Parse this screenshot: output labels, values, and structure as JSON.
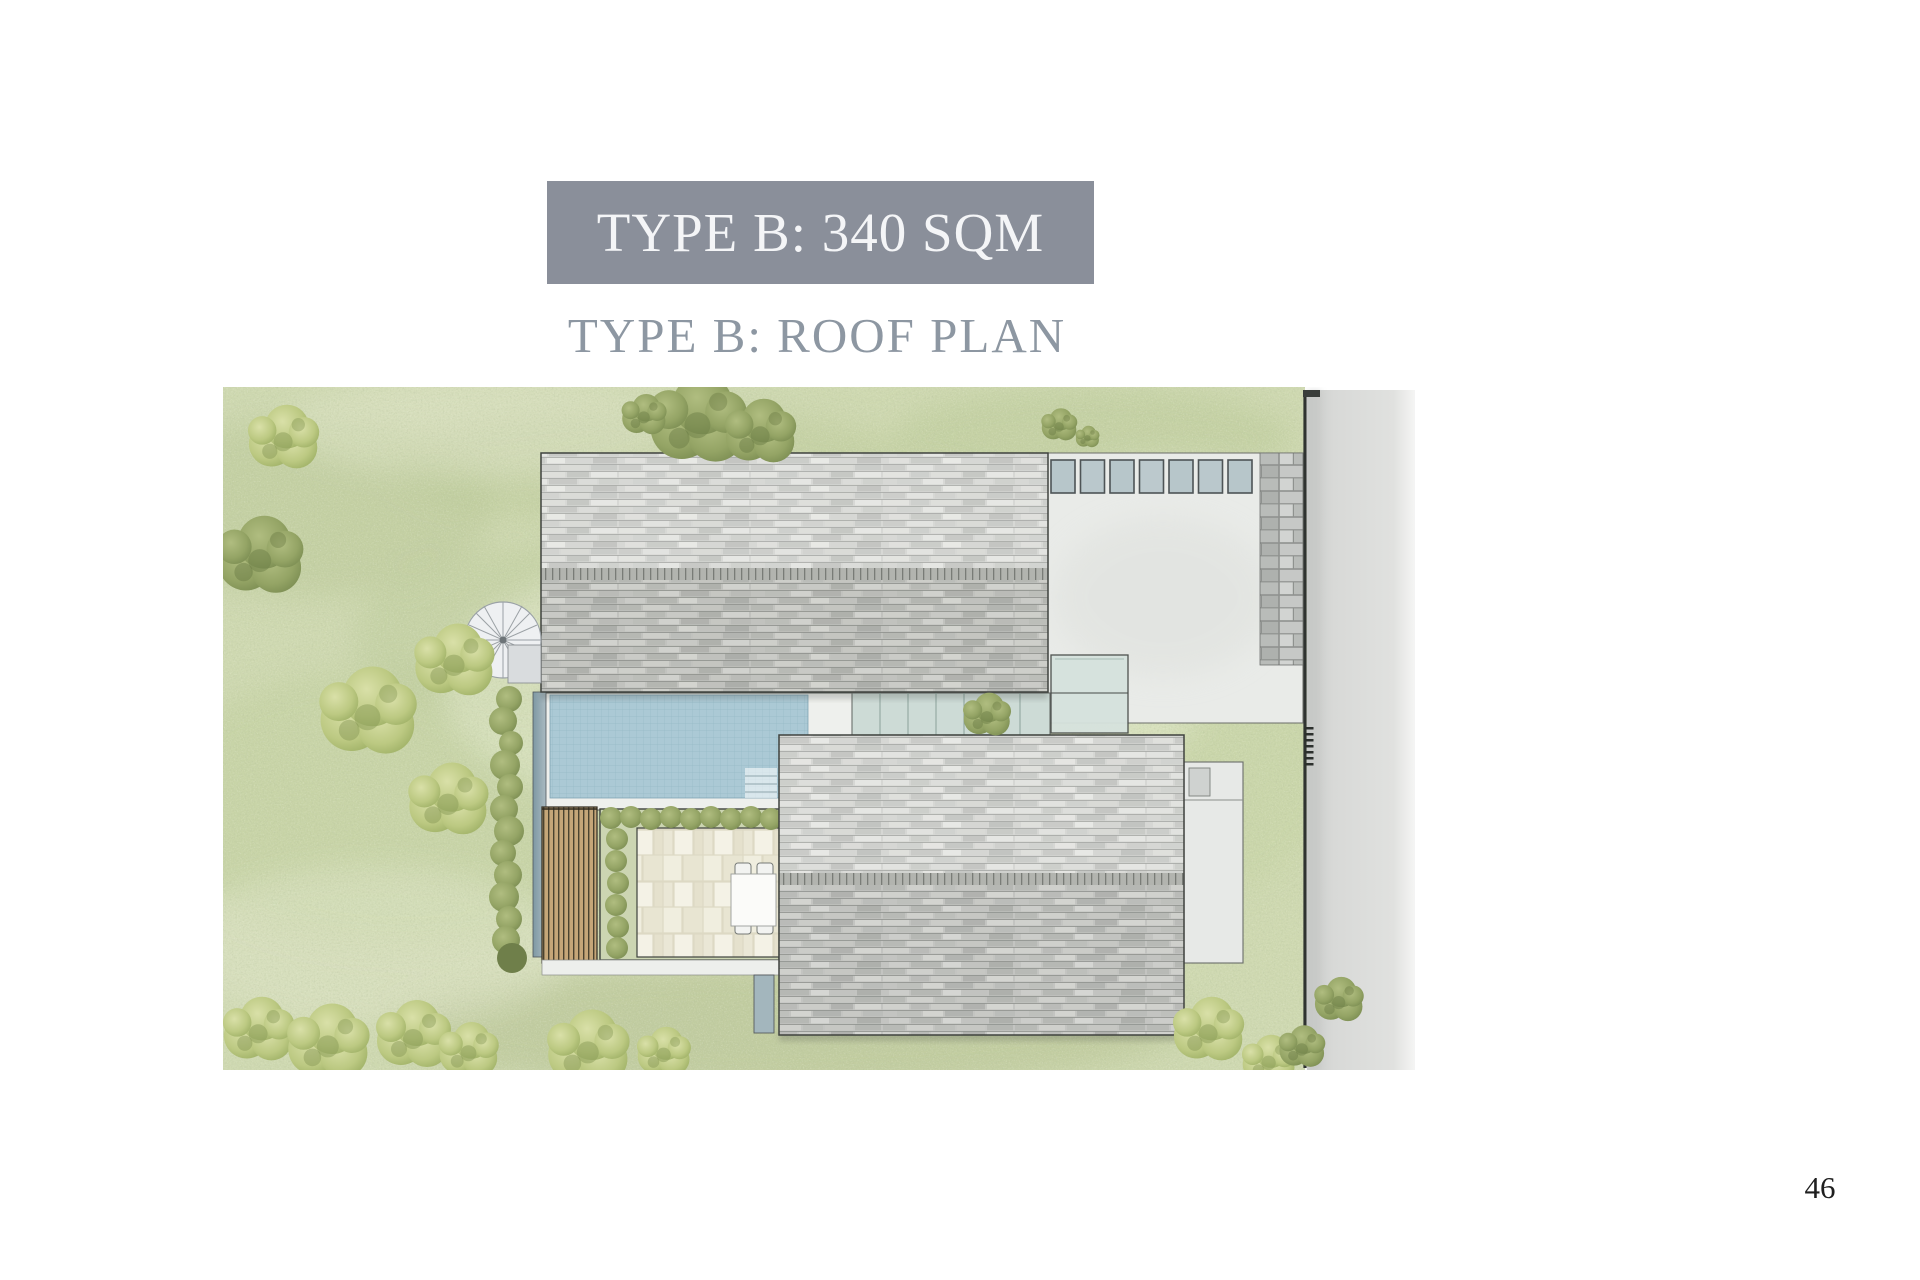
{
  "page": {
    "title_banner": "TYPE B: 340 SQM",
    "subtitle": "TYPE B: ROOF PLAN",
    "page_number": "46"
  },
  "plan": {
    "alt": "Watercolor roof plan: two grey shingled roofs, concrete terrace with seven skylights, stone paver path, swimming pool, glass canopy, spiral stair, timber pergola, paved courtyard with dining table, lawn with trees, side road"
  },
  "theme": {
    "page-bg": "#ffffff",
    "banner-bg": "#8a8f9a",
    "banner-text": "#f4f5f7",
    "subtitle-color": "#8d97a2",
    "page-number-color": "#1f1f1f",
    "grass": "#cfd9b1",
    "road": "#d7d8d6",
    "roof-shingle": "#cfd0cc",
    "ridge": "#b2b4af",
    "pool": "#abc9d5",
    "glass": "#cddbd6",
    "terrace": "#e9ebe8",
    "pergola-wood": "#c5a678",
    "paver": "#f0eedf",
    "hedge-green": "#8a9a5e",
    "boundary-line": "#2f3330"
  }
}
